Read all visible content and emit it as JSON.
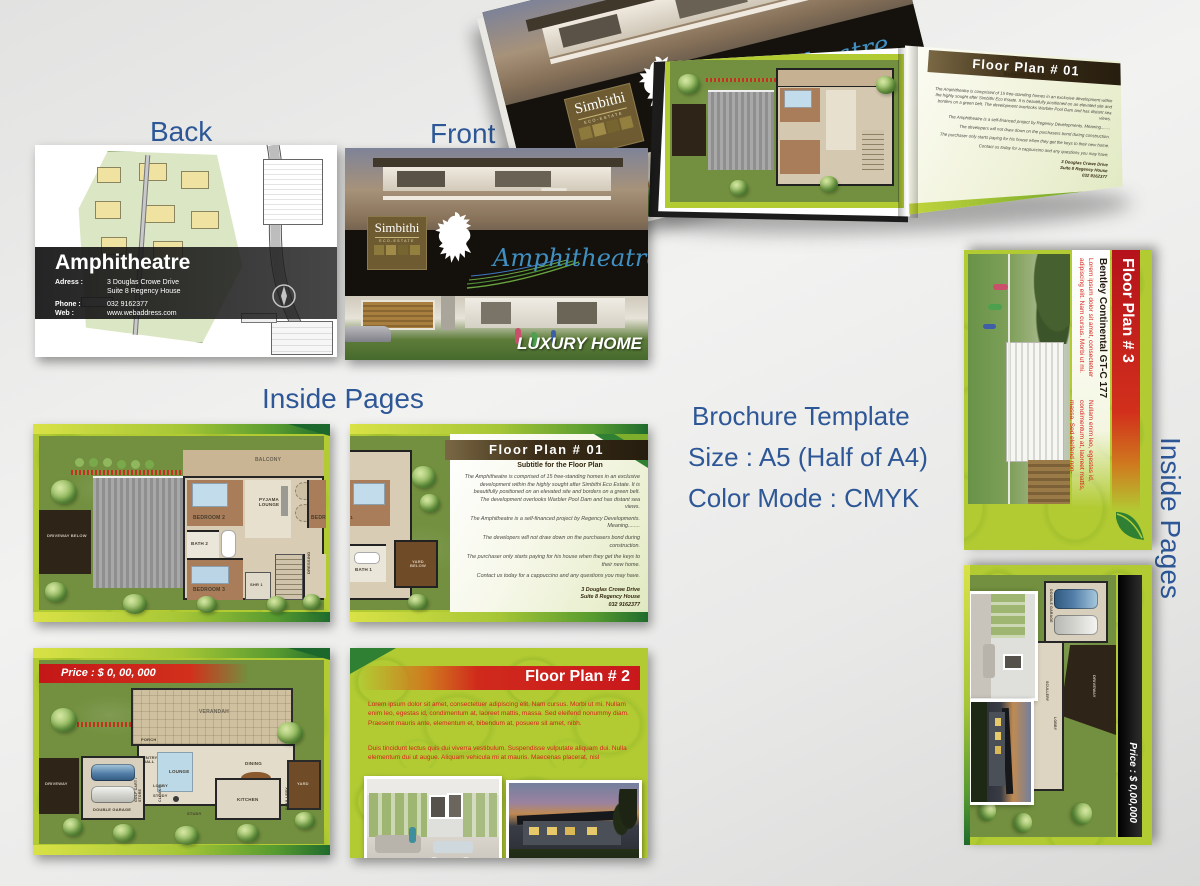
{
  "colors": {
    "heading_blue": "#2d5796",
    "page_lime": "#b2cb33",
    "lawn_green": "#72903f",
    "header_brown": "#33270f",
    "band_red": "#c9181c",
    "body_red": "#d6231e",
    "price_band_black": "#111111",
    "script_blue": "#2e7fb5"
  },
  "headings": {
    "back": "Back",
    "front": "Front",
    "inside_pages": "Inside Pages",
    "inside_pages_side": "Inside Pages"
  },
  "info": {
    "line1": "Brochure Template",
    "line2": "Size : A5 (Half of A4)",
    "line3": "Color Mode : CMYK"
  },
  "back_card": {
    "title": "Amphitheatre",
    "address_label": "Adress :",
    "address_line1": "3 Douglas Crowe Drive",
    "address_line2": "Suite 8 Regency House",
    "phone_label": "Phone :",
    "phone": "032 9162377",
    "web_label": "Web :",
    "web": "www.webaddress.com"
  },
  "front_card": {
    "logo_title": "Simbithi",
    "logo_subtitle": "ECO-ESTATE",
    "name_script": "Amphitheatre",
    "tagline": "LUXURY HOME"
  },
  "book": {
    "header": "Floor Plan  #  01",
    "subtitle": "Subtitle for the Floor Plan"
  },
  "fp1_page": {
    "header": "Floor Plan  #  01",
    "subtitle": "Subtitle for the Floor Plan",
    "paragraphs": [
      "The Amphitheatre is comprised of 15 free-standing homes in an exclusive development within the highly sought after Simbithi Eco Estate.  It is beautifully positioned on an elevated site and borders on a green belt.  The development overlooks Warbler Pool Dam and has distant sea views.",
      "The Amphitheatre is a self-financed project by Regency Developments.  Meaning........",
      "The developers will not draw down on the purchasers bond during construction.",
      "The purchaser only starts paying for his house when they get the keys to their new home.",
      "Contact us today for a cappuccino and any questions you may have."
    ],
    "address": [
      "3 Douglas Crowe Drive",
      "Suite 8 Regency House",
      "032 9162377"
    ]
  },
  "fp2_page": {
    "header": "Floor Plan # 2",
    "paragraphs": [
      "Lorem ipsum dolor sit amet, consectetuer adipiscing elit. Nam cursus. Morbi ut mi. Nullam enim leo, egestas id, condimentum at, laoreet mattis, massa. Sed eleifend nonummy diam. Praesent mauris ante, elementum et, bibendum at, posuere sit amet, nibh.",
      "Duis tincidunt lectus quis dui viverra vestibulum. Suspendisse vulputate aliquam dui. Nulla elementum dui ut augue. Aliquam vehicula mi at mauris. Maecenas placerat, nisl"
    ]
  },
  "fp3_page": {
    "header": "Floor Plan # 3",
    "car_title": "Bentley Continental GT-C 177",
    "col1": "Lorem ipsum dolor sit amet, consectetuer adipiscing elit. Nam cursus. Morbi ut mi.",
    "col2": "Nullam enim leo, egestas id, condimentum at, laoreet mattis, massa. Sed eleifend non-"
  },
  "price_page_a": {
    "price": "Price : $ 0, 00, 000"
  },
  "price_page_b": {
    "price": "Price : $ 0,00,000"
  },
  "floorplan_a": {
    "rooms": [
      "BALCONY",
      "PYJAMA LOUNGE",
      "BEDROOM 2",
      "BATH 2",
      "BEDROOM 3",
      "SHR 1",
      "DRESSING",
      "DRIVEWAY BELOW",
      "BEDROOM 1"
    ]
  },
  "floorplan_b": {
    "rooms": [
      "BEDROOM 1",
      "BATH 1",
      "YARD BELOW"
    ]
  },
  "floorplan_c": {
    "rooms": [
      "VERANDAH",
      "LOUNGE",
      "DINING",
      "DOUBLE GARAGE",
      "ENTRY HALL",
      "PORCH",
      "LOBBY",
      "STUDY",
      "KITCHEN",
      "SCULLERY",
      "YARD",
      "DRIVEWAY",
      "GOLF CART / STORE",
      "CLOAKS"
    ]
  },
  "floorplan_f": {
    "rooms": [
      "DOUBLE GARAGE",
      "DRIVEWAY",
      "LOBBY",
      "SCULLERY",
      "KITCHEN",
      "DINING",
      "VERANDAH",
      "LOUNGE",
      "HALL"
    ]
  }
}
